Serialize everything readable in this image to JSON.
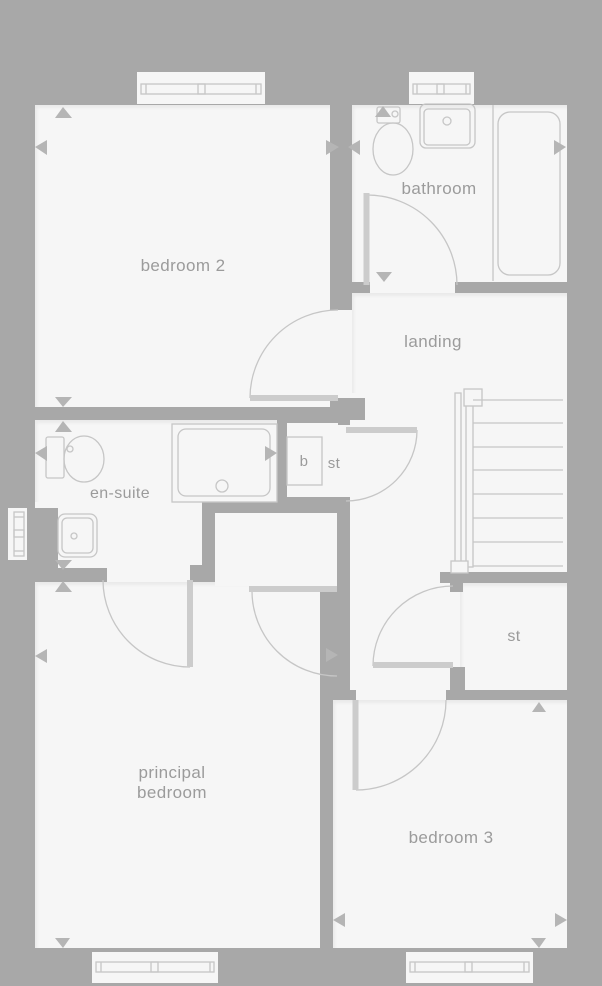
{
  "floor_plan": {
    "labels": {
      "bedroom2": "bedroom 2",
      "bathroom": "bathroom",
      "landing": "landing",
      "ensuite": "en-suite",
      "boiler": "b",
      "cupboard_st": "st",
      "store_st": "st",
      "principal_line1": "principal",
      "principal_line2": "bedroom",
      "bedroom3": "bedroom 3"
    },
    "colors": {
      "exterior_and_walls": "#a8a8a8",
      "floor": "#f6f6f6",
      "fixture_outline": "#c6c6c6",
      "door_leaf": "#cccccc",
      "label_text": "#9b9b9b",
      "dimension_marker": "#b5b5b5"
    }
  }
}
